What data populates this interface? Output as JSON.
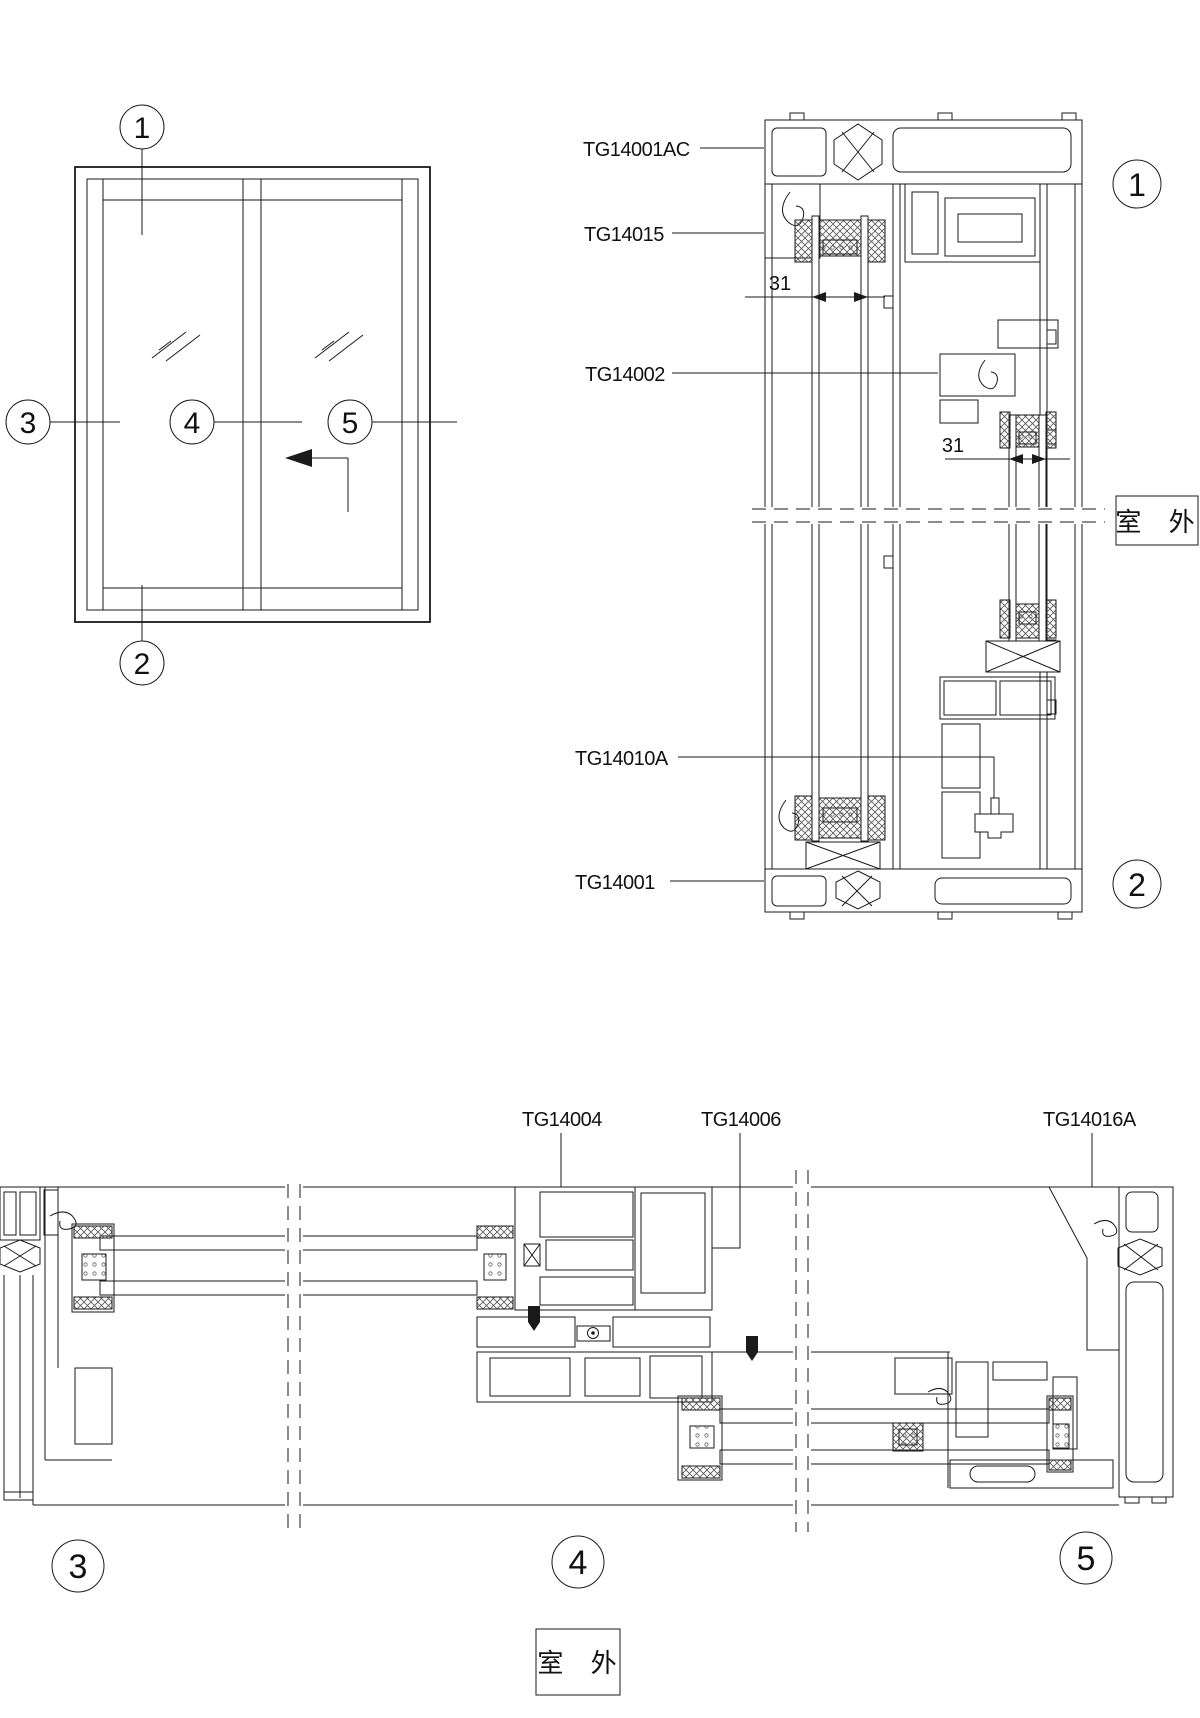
{
  "elevation": {
    "markers": {
      "top": "1",
      "bottom": "2",
      "left": "3",
      "center": "4",
      "right": "5"
    }
  },
  "vertical_section": {
    "part_labels": {
      "head_frame": "TG14001AC",
      "top_subframe": "TG14015",
      "sash_rail": "TG14002",
      "bottom_clip": "TG14010A",
      "sill_frame": "TG14001"
    },
    "dimensions": {
      "upper_glass_width": "31",
      "lower_glass_width": "31"
    },
    "outdoor_label": "室 外",
    "markers": {
      "top": "1",
      "bottom": "2"
    }
  },
  "horizontal_section": {
    "part_labels": {
      "left_meeting_stile": "TG14004",
      "interlock": "TG14006",
      "right_jamb": "TG14016A"
    },
    "outdoor_label": "室 外",
    "markers": {
      "left": "3",
      "center": "4",
      "right": "5"
    }
  },
  "colors": {
    "line": "#1a1a1a",
    "background": "#ffffff"
  }
}
